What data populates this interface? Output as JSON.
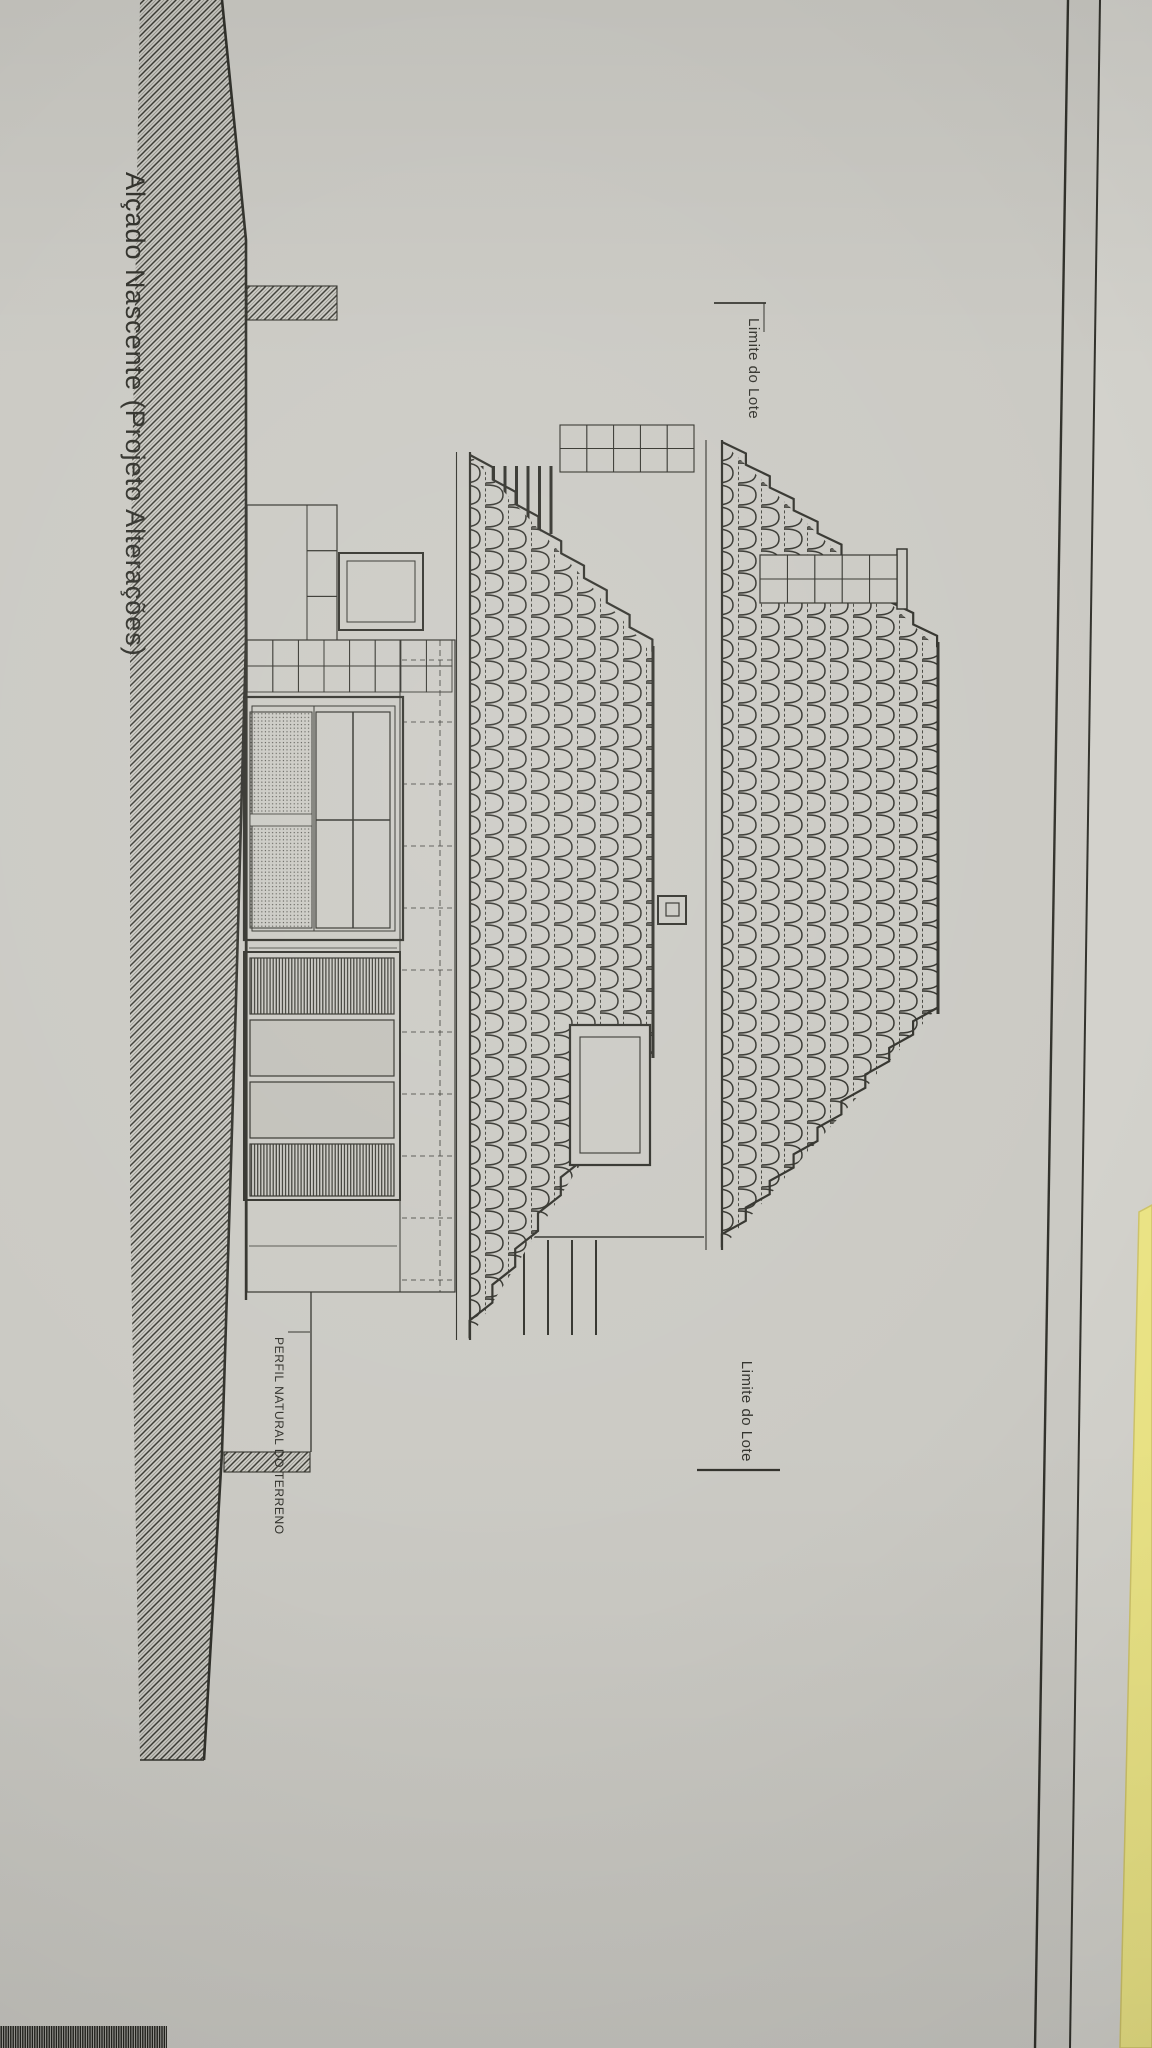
{
  "sheet": {
    "title": "Alçado Nascente (Projeto Alterações)",
    "labels": {
      "lot_boundary": "Limite do Lote",
      "natural_terrain_profile": "PERFIL NATURAL DO TERRENO"
    }
  },
  "colors": {
    "paper": "#cbcac4",
    "paper_light": "#d3d2cc",
    "backing_paper": "#cfceca",
    "ink": "#32322c",
    "ink_light": "#56564f",
    "table_yellow": "#ece586",
    "table_yellow_edge": "#cfc46a",
    "panel_shade": "#c2c1ba"
  }
}
